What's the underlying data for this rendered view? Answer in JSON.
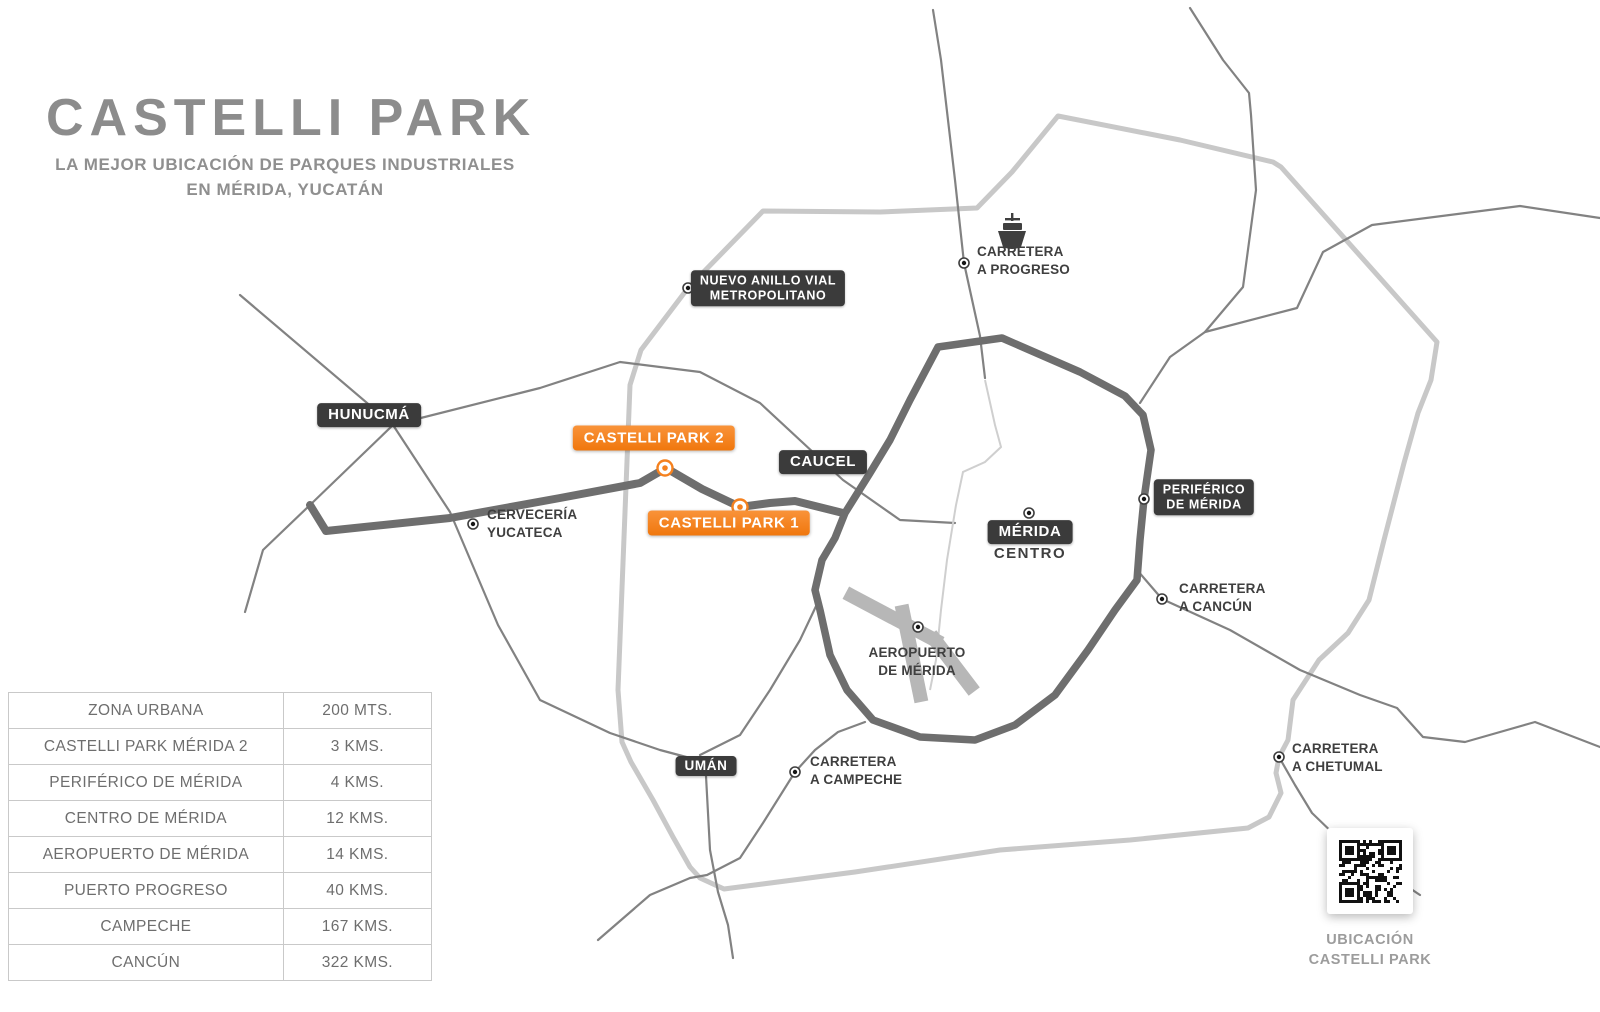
{
  "header": {
    "title": "CASTELLI PARK",
    "subtitle_line1": "LA MEJOR UBICACIÓN DE PARQUES INDUSTRIALES",
    "subtitle_line2": "EN MÉRIDA, YUCATÁN"
  },
  "distance_table": {
    "rows": [
      {
        "label": "ZONA URBANA",
        "value": "200 MTS."
      },
      {
        "label": "CASTELLI PARK MÉRIDA 2",
        "value": "3 KMS."
      },
      {
        "label": "PERIFÉRICO DE MÉRIDA",
        "value": "4 KMS."
      },
      {
        "label": "CENTRO DE MÉRIDA",
        "value": "12 KMS."
      },
      {
        "label": "AEROPUERTO DE MÉRIDA",
        "value": "14 KMS."
      },
      {
        "label": "PUERTO PROGRESO",
        "value": "40 KMS."
      },
      {
        "label": "CAMPECHE",
        "value": "167 KMS."
      },
      {
        "label": "CANCÚN",
        "value": "322 KMS."
      }
    ]
  },
  "map": {
    "badges": {
      "hunucma": {
        "text": "HUNUCMÁ"
      },
      "caucel": {
        "text": "CAUCEL"
      },
      "uman": {
        "text": "UMÁN"
      },
      "merida": {
        "text": "MÉRIDA",
        "sub": "CENTRO"
      },
      "anillo": {
        "lines": [
          "NUEVO ANILLO VIAL",
          "METROPOLITANO"
        ]
      },
      "periferico": {
        "lines": [
          "PERIFÉRICO",
          "DE MÉRIDA"
        ]
      },
      "castelli_park_2": {
        "text": "CASTELLI PARK 2"
      },
      "castelli_park_1": {
        "text": "CASTELLI PARK 1"
      }
    },
    "labels": {
      "carretera_progreso": {
        "lines": [
          "CARRETERA",
          "A PROGRESO"
        ]
      },
      "cerveceria": {
        "lines": [
          "CERVECERÍA",
          "YUCATECA"
        ]
      },
      "carretera_cancun": {
        "lines": [
          "CARRETERA",
          "A CANCÚN"
        ]
      },
      "carretera_campeche": {
        "lines": [
          "CARRETERA",
          "A CAMPECHE"
        ]
      },
      "carretera_chetumal": {
        "lines": [
          "CARRETERA",
          "A CHETUMAL"
        ]
      },
      "aeropuerto": {
        "lines": [
          "AEROPUERTO",
          "DE MÉRIDA"
        ]
      }
    },
    "qr_caption": {
      "lines": [
        "UBICACIÓN",
        "CASTELLI PARK"
      ]
    }
  },
  "colors": {
    "accent_orange": "#f5811e",
    "badge_dark": "#3b3b3b",
    "road_light": "#c8c8c8",
    "road_dark": "#6e6e6e",
    "title_gray": "#8c8c8c"
  }
}
